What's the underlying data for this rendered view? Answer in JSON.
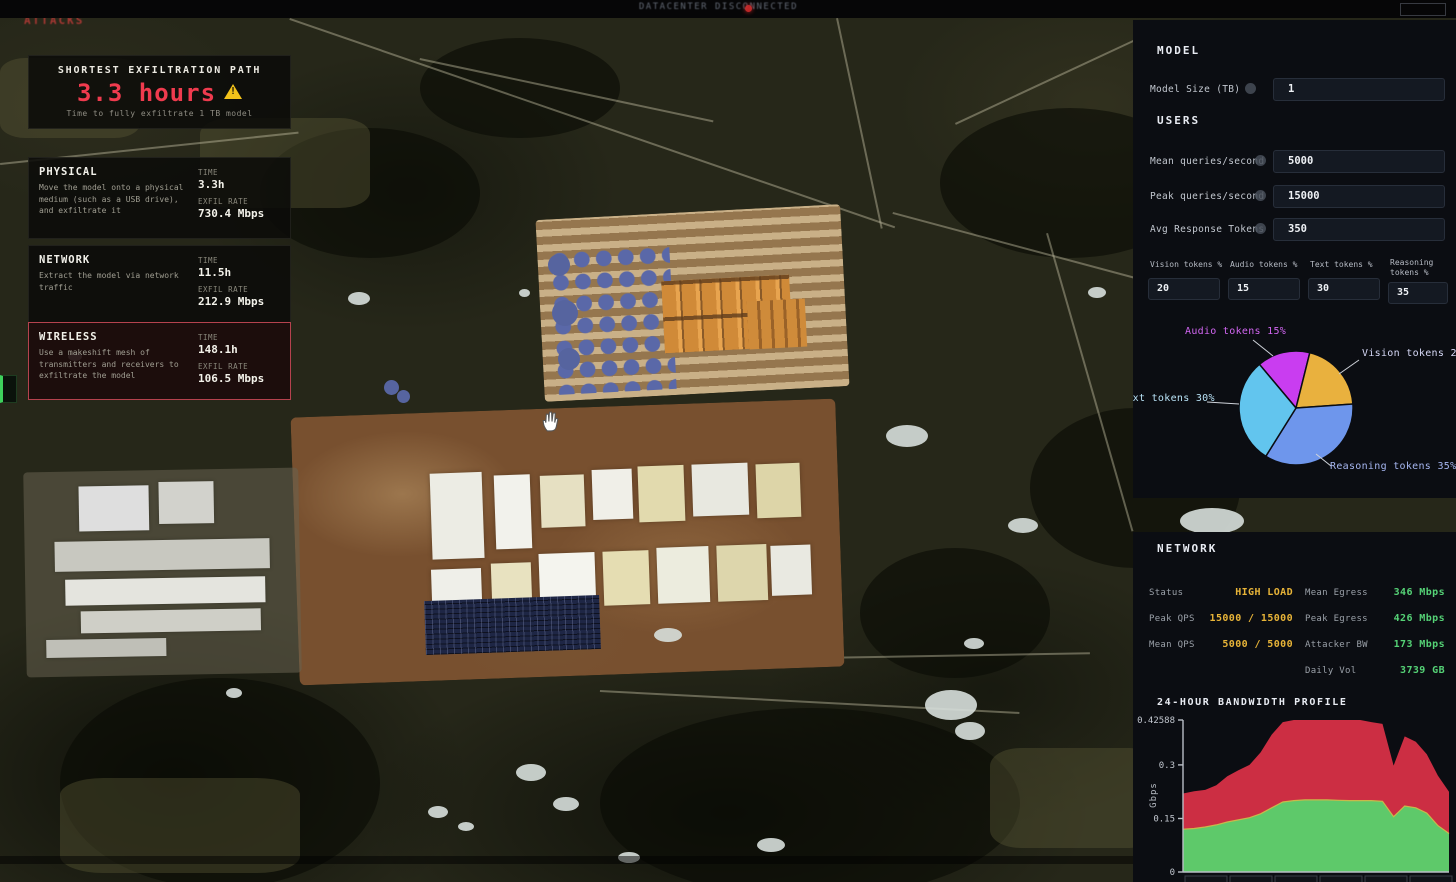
{
  "top_bar": {
    "title": "DATACENTER DISCONNECTED"
  },
  "attacks_panel": {
    "watermark": "ATTACKS",
    "header": {
      "title": "SHORTEST EXFILTRATION PATH",
      "time": "3.3 hours",
      "subtitle": "Time to fully exfiltrate 1 TB model"
    },
    "time_label": "TIME",
    "rate_label": "EXFIL RATE",
    "attacks": [
      {
        "name": "PHYSICAL",
        "description": "Move the model onto a physical medium (such as a USB drive), and exfiltrate it",
        "time": "3.3h",
        "exfil_rate": "730.4 Mbps",
        "selected": false
      },
      {
        "name": "NETWORK",
        "description": "Extract the model via network traffic",
        "time": "11.5h",
        "exfil_rate": "212.9 Mbps",
        "selected": false
      },
      {
        "name": "WIRELESS",
        "description": "Use a makeshift mesh of transmitters and receivers to exfiltrate the model",
        "time": "148.1h",
        "exfil_rate": "106.5 Mbps",
        "selected": true
      }
    ]
  },
  "model_panel": {
    "model_header": "MODEL",
    "model_size": {
      "label": "Model Size (TB)",
      "value": "1"
    },
    "users_header": "USERS",
    "fields": [
      {
        "label": "Mean queries/second",
        "value": "5000"
      },
      {
        "label": "Peak queries/second",
        "value": "15000"
      },
      {
        "label": "Avg Response Tokens",
        "value": "350"
      }
    ],
    "token_fields": [
      {
        "label": "Vision tokens %",
        "value": "20"
      },
      {
        "label": "Audio tokens %",
        "value": "15"
      },
      {
        "label": "Text tokens %",
        "value": "30"
      },
      {
        "label": "Reasoning tokens %",
        "value": "35"
      }
    ]
  },
  "network_panel": {
    "header": "NETWORK",
    "left_stats": [
      {
        "label": "Status",
        "value": "HIGH LOAD"
      },
      {
        "label": "Peak QPS",
        "value": "15000 / 15000"
      },
      {
        "label": "Mean QPS",
        "value": "5000 / 5000"
      }
    ],
    "right_stats": [
      {
        "label": "Mean Egress",
        "value": "346 Mbps"
      },
      {
        "label": "Peak Egress",
        "value": "426 Mbps"
      },
      {
        "label": "Attacker BW",
        "value": "173 Mbps"
      },
      {
        "label": "Daily Vol",
        "value": "3739 GB"
      }
    ]
  },
  "chart_data": [
    {
      "type": "pie",
      "title": "Token distribution",
      "start_angle_deg": -40,
      "slices": [
        {
          "label": "Audio tokens 15%",
          "value": 15,
          "color": "#c93df0"
        },
        {
          "label": "Vision tokens 20%",
          "value": 20,
          "color": "#e9b13e"
        },
        {
          "label": "Reasoning tokens 35%",
          "value": 35,
          "color": "#6e96ec"
        },
        {
          "label": "Text tokens 30%",
          "value": 30,
          "color": "#62c5ee"
        }
      ],
      "legend_position": "callout-labels"
    },
    {
      "type": "area",
      "title": "24-HOUR BANDWIDTH PROFILE",
      "ylabel": "Gbps",
      "ylim": [
        0,
        0.42588
      ],
      "yticks": [
        0,
        0.15,
        0.3,
        0.42588
      ],
      "ytick_labels": [
        "0",
        "0.15",
        "0.3",
        "0.42588"
      ],
      "x_hours": [
        0,
        1,
        2,
        3,
        4,
        5,
        6,
        7,
        8,
        9,
        10,
        11,
        12,
        13,
        14,
        15,
        16,
        17,
        18,
        19,
        20,
        21,
        22,
        23,
        24
      ],
      "grid": false,
      "series": [
        {
          "name": "baseline-traffic",
          "color": "#5ec96a",
          "edge_color": "#c9b84a",
          "values": [
            0.12,
            0.122,
            0.126,
            0.132,
            0.14,
            0.146,
            0.152,
            0.163,
            0.18,
            0.196,
            0.2,
            0.202,
            0.202,
            0.202,
            0.201,
            0.2,
            0.2,
            0.2,
            0.198,
            0.155,
            0.185,
            0.18,
            0.165,
            0.13,
            0.108
          ]
        },
        {
          "name": "total-with-attack",
          "color": "#cc2e43",
          "values": [
            0.22,
            0.226,
            0.23,
            0.243,
            0.268,
            0.285,
            0.3,
            0.335,
            0.385,
            0.42,
            0.4259,
            0.4259,
            0.4259,
            0.4259,
            0.4259,
            0.4259,
            0.4259,
            0.42,
            0.415,
            0.298,
            0.38,
            0.365,
            0.33,
            0.27,
            0.225
          ]
        }
      ]
    }
  ]
}
